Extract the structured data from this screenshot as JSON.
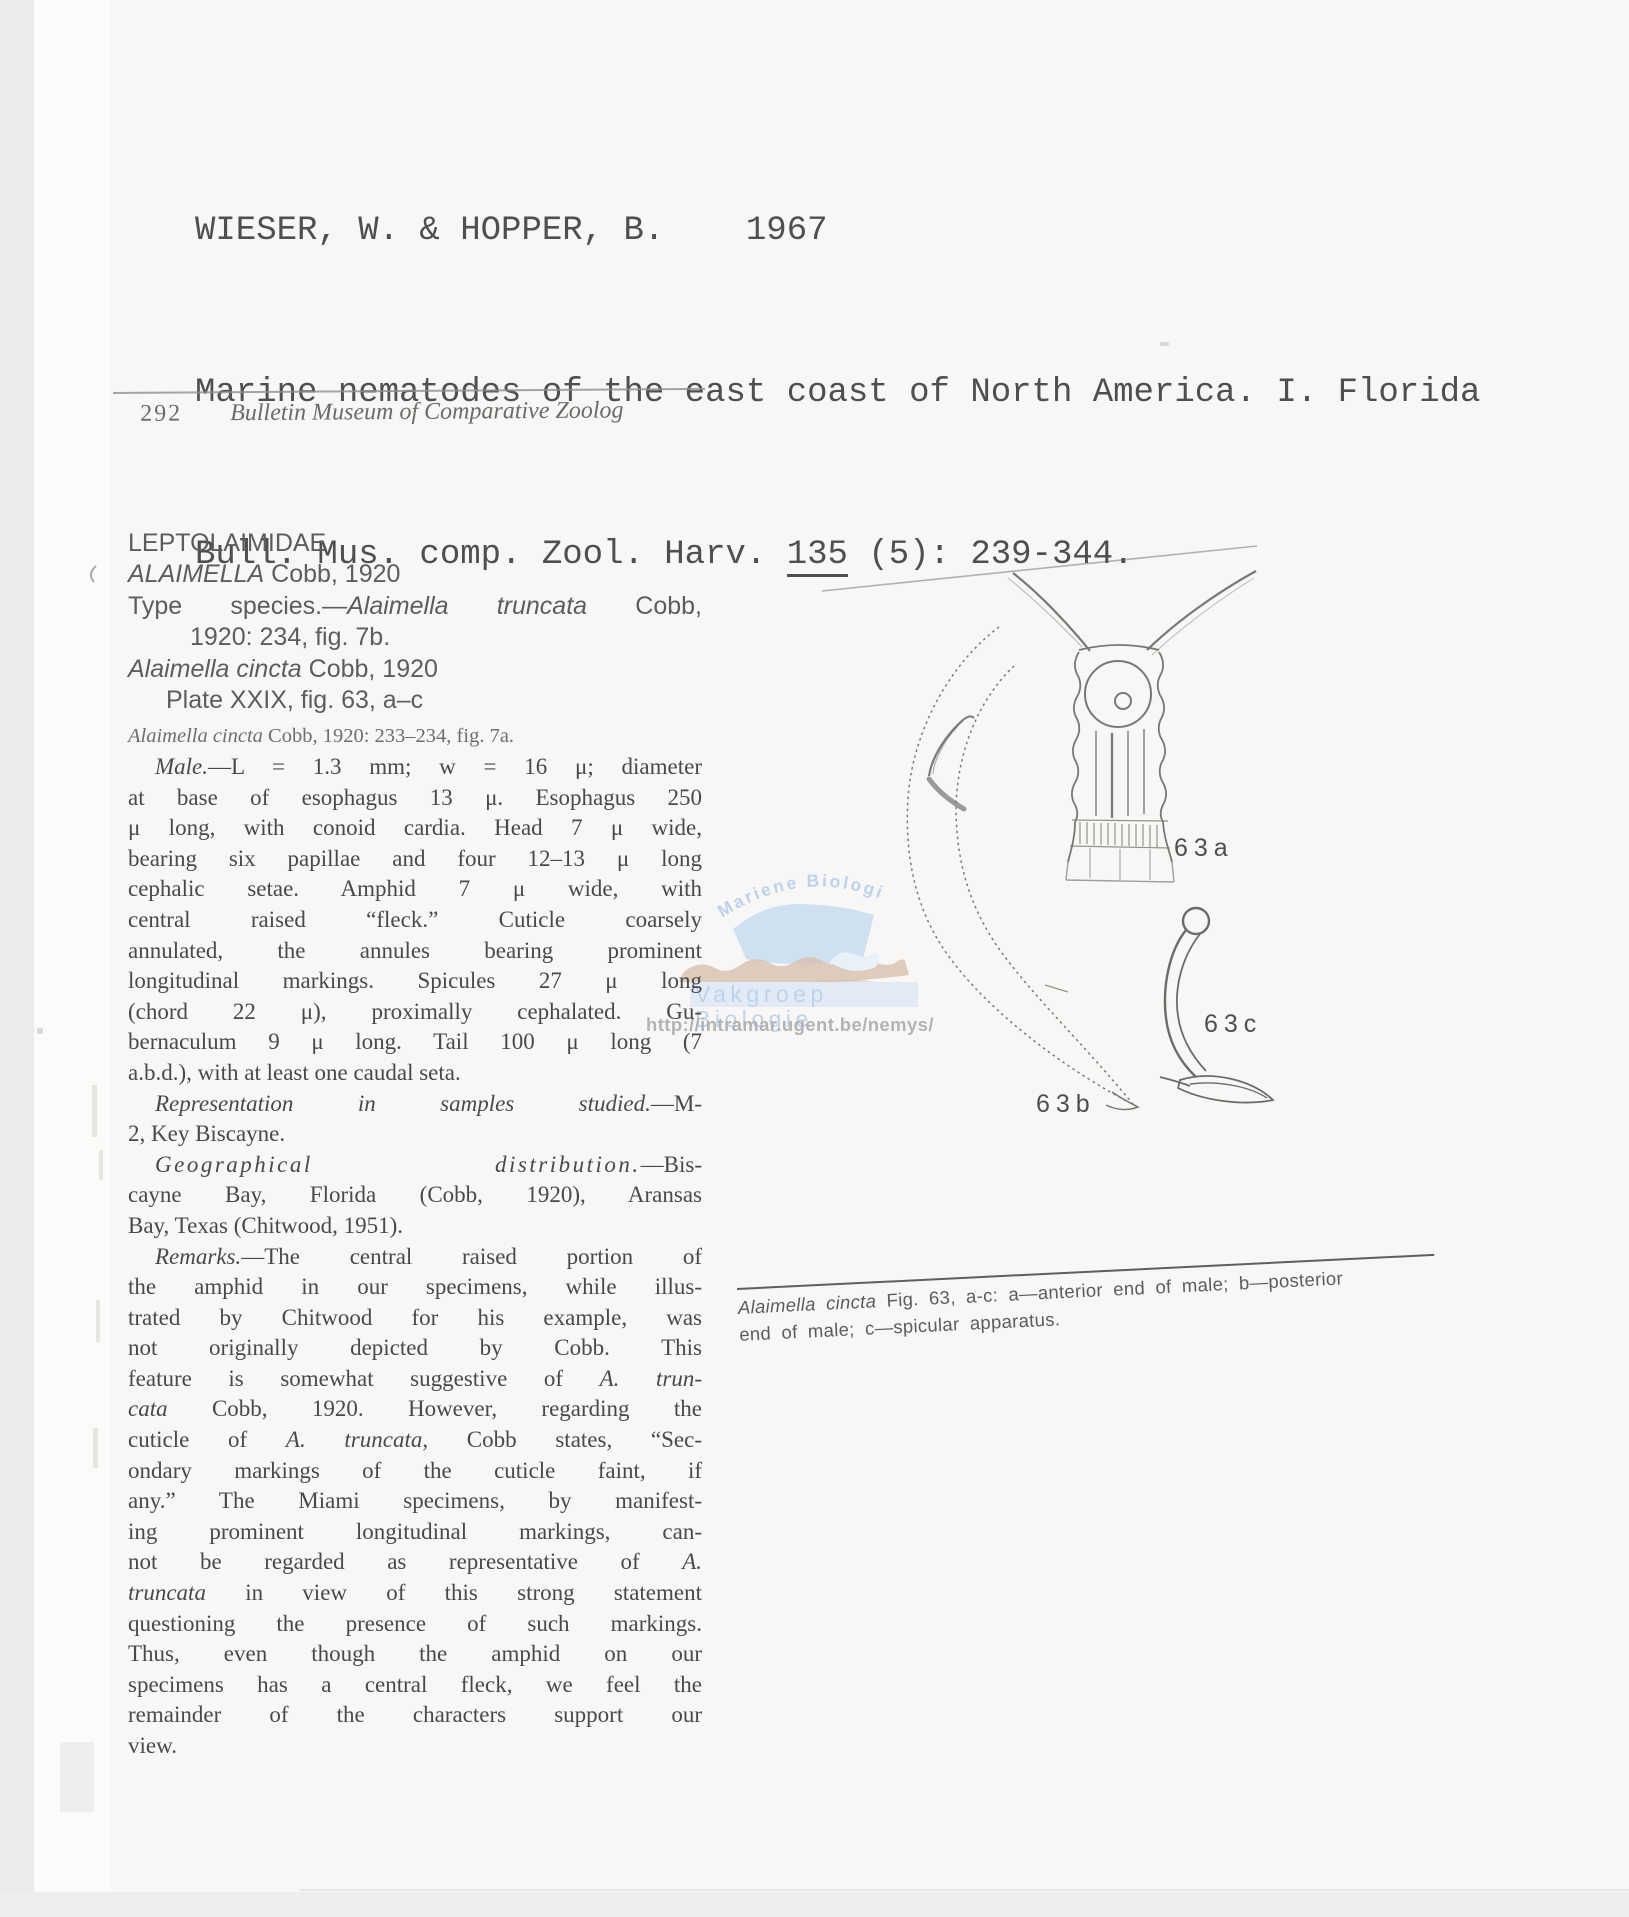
{
  "page": {
    "bg": "#f8f7f5",
    "edge_gray": "#ebebeb",
    "ink": "#4a4a4a"
  },
  "citation": {
    "authors_line": "WIESER, W. & HOPPER, B.    1967",
    "title_line": "Marine nematodes of the east coast of North America. I. Florida",
    "journal_prefix": "Bull. Mus. comp. Zool. Harv. ",
    "volume": "135",
    "journal_suffix": " (5): 239-344."
  },
  "running_header": {
    "page_number": "292",
    "journal_title": "Bulletin Museum of Comparative Zoolog"
  },
  "article": {
    "head": [
      {
        "cls": "",
        "segs": [
          {
            "t": "LEPTOLAIMIDAE"
          }
        ]
      },
      {
        "cls": "",
        "segs": [
          {
            "t": "ALAIMELLA",
            "i": 1
          },
          {
            "t": " Cobb, 1920"
          }
        ]
      },
      {
        "cls": "j",
        "segs": [
          {
            "t": "Type species.—"
          },
          {
            "t": "Alaimella truncata",
            "i": 1
          },
          {
            "t": " Cobb,"
          }
        ]
      },
      {
        "cls": "ind2",
        "segs": [
          {
            "t": "1920: 234, fig. 7b."
          }
        ]
      },
      {
        "cls": "",
        "segs": [
          {
            "t": "Alaimella cincta",
            "i": 1
          },
          {
            "t": " Cobb, 1920"
          }
        ]
      },
      {
        "cls": "ind1",
        "segs": [
          {
            "t": "Plate XXIX, fig. 63, a–c"
          }
        ]
      },
      {
        "cls": "syn",
        "segs": [
          {
            "t": "Alaimella cincta",
            "i": 1
          },
          {
            "t": " Cobb, 1920: 233–234, fig. 7a."
          }
        ]
      }
    ],
    "body": [
      {
        "cls": "first",
        "segs": [
          {
            "t": "Male.",
            "i": 1
          },
          {
            "t": "—L = 1.3 mm; w = 16 μ; diameter"
          }
        ]
      },
      {
        "cls": "",
        "segs": [
          {
            "t": "at base of esophagus 13 μ. Esophagus 250"
          }
        ]
      },
      {
        "cls": "",
        "segs": [
          {
            "t": "μ long, with conoid cardia. Head 7 μ wide,"
          }
        ]
      },
      {
        "cls": "",
        "segs": [
          {
            "t": "bearing six papillae and four 12–13 μ long"
          }
        ]
      },
      {
        "cls": "",
        "segs": [
          {
            "t": "cephalic setae. Amphid 7 μ wide, with"
          }
        ]
      },
      {
        "cls": "",
        "segs": [
          {
            "t": "central raised “fleck.”  Cuticle coarsely"
          }
        ]
      },
      {
        "cls": "",
        "segs": [
          {
            "t": "annulated, the annules bearing prominent"
          }
        ]
      },
      {
        "cls": "",
        "segs": [
          {
            "t": "longitudinal markings. Spicules 27 μ long"
          }
        ]
      },
      {
        "cls": "",
        "segs": [
          {
            "t": "(chord 22 μ), proximally cephalated. Gu-"
          }
        ]
      },
      {
        "cls": "",
        "segs": [
          {
            "t": "bernaculum 9 μ long. Tail 100 μ long (7"
          }
        ]
      },
      {
        "cls": "end",
        "segs": [
          {
            "t": "a.b.d.), with at least one caudal seta."
          }
        ]
      },
      {
        "cls": "first",
        "segs": [
          {
            "t": "Representation in samples studied.",
            "i": 1
          },
          {
            "t": "—M-"
          }
        ]
      },
      {
        "cls": "end",
        "segs": [
          {
            "t": "2, Key Biscayne."
          }
        ]
      },
      {
        "cls": "first",
        "segs": [
          {
            "t": "Geographical distribution.",
            "i": 1,
            "sp": 1
          },
          {
            "t": "—Bis-"
          }
        ]
      },
      {
        "cls": "",
        "segs": [
          {
            "t": "cayne Bay, Florida (Cobb, 1920), Aransas"
          }
        ]
      },
      {
        "cls": "end",
        "segs": [
          {
            "t": "Bay, Texas (Chitwood, 1951)."
          }
        ]
      },
      {
        "cls": "first",
        "segs": [
          {
            "t": "Remarks.",
            "i": 1
          },
          {
            "t": "—The central raised portion of"
          }
        ]
      },
      {
        "cls": "",
        "segs": [
          {
            "t": "the amphid in our specimens, while illus-"
          }
        ]
      },
      {
        "cls": "",
        "segs": [
          {
            "t": "trated by Chitwood for his example, was"
          }
        ]
      },
      {
        "cls": "",
        "segs": [
          {
            "t": "not originally depicted by Cobb. This"
          }
        ]
      },
      {
        "cls": "",
        "segs": [
          {
            "t": "feature is somewhat suggestive of "
          },
          {
            "t": "A. trun-",
            "i": 1
          }
        ]
      },
      {
        "cls": "",
        "segs": [
          {
            "t": "cata",
            "i": 1
          },
          {
            "t": " Cobb, 1920. However, regarding the"
          }
        ]
      },
      {
        "cls": "",
        "segs": [
          {
            "t": "cuticle of "
          },
          {
            "t": "A. truncata",
            "i": 1
          },
          {
            "t": ", Cobb states, “Sec-"
          }
        ]
      },
      {
        "cls": "",
        "segs": [
          {
            "t": "ondary markings of the cuticle faint, if"
          }
        ]
      },
      {
        "cls": "",
        "segs": [
          {
            "t": "any.” The Miami specimens, by manifest-"
          }
        ]
      },
      {
        "cls": "",
        "segs": [
          {
            "t": "ing prominent longitudinal markings, can-"
          }
        ]
      },
      {
        "cls": "",
        "segs": [
          {
            "t": "not be regarded as representative of "
          },
          {
            "t": "A.",
            "i": 1
          }
        ]
      },
      {
        "cls": "",
        "segs": [
          {
            "t": "truncata",
            "i": 1
          },
          {
            "t": " in view of this strong statement"
          }
        ]
      },
      {
        "cls": "",
        "segs": [
          {
            "t": "questioning the presence of such markings."
          }
        ]
      },
      {
        "cls": "",
        "segs": [
          {
            "t": "Thus, even though the amphid on our"
          }
        ]
      },
      {
        "cls": "",
        "segs": [
          {
            "t": "specimens has a central fleck, we feel the"
          }
        ]
      },
      {
        "cls": "",
        "segs": [
          {
            "t": "remainder of the characters support our"
          }
        ]
      },
      {
        "cls": "end",
        "segs": [
          {
            "t": "view."
          }
        ]
      }
    ]
  },
  "figure": {
    "label_a": "63a",
    "label_b": "63b",
    "label_c": "63c",
    "caption_italic": "Alaimella cincta",
    "caption_rest": " Fig. 63, a-c:  a—anterior end of male; b—posterior",
    "caption_line2": "end of male; c—spicular apparatus."
  },
  "watermark": {
    "arc_text": "Mariene Biologie",
    "band_text": "Vakgroep Biologie",
    "url": "http://intramar.ugent.be/nemys/",
    "blue": "#cfe0f1",
    "band_blue": "#e2ebf5",
    "text_blue": "#bdd3eb",
    "wave_brown": "#d8bfae",
    "url_gray": "#b3b3b3"
  }
}
